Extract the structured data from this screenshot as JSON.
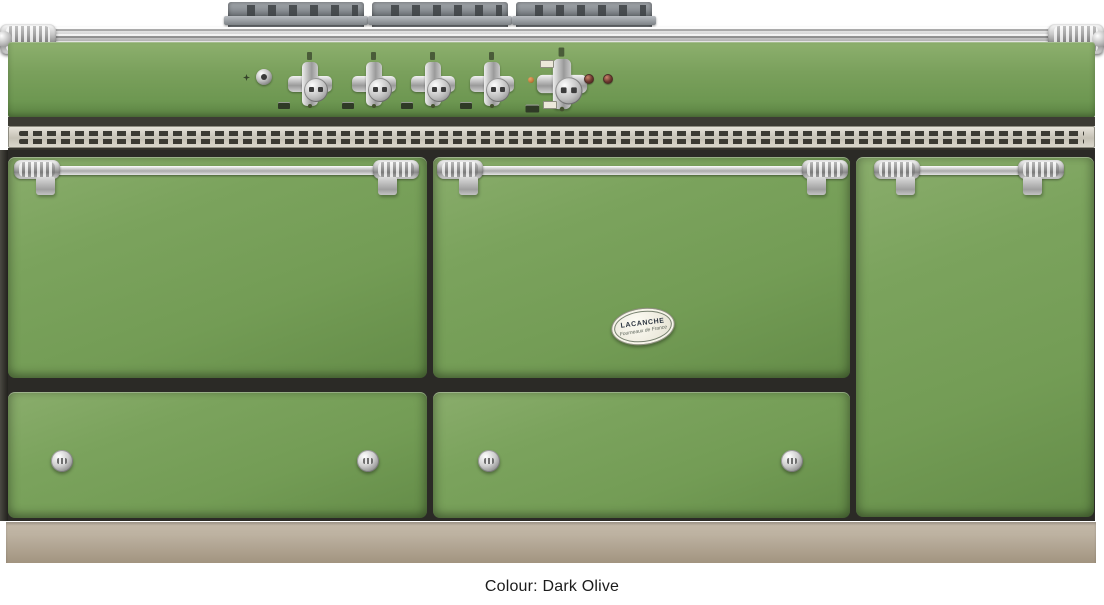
{
  "caption": {
    "text": "Colour: Dark Olive"
  },
  "product": {
    "brand": "Lacanche",
    "colour_name": "Dark Olive",
    "type": "range cooker product photo"
  },
  "badge": {
    "title": "LACANCHE",
    "subtitle": "Fourneaux de France"
  },
  "icons": {
    "burner_knob": "chrome cross-shaped control knob",
    "oven_knob": "large chrome cross-shaped oven knob",
    "ignition_button": "round chrome push button",
    "spark_icon": "small star spark symbol",
    "indicator_light": "round red indicator light",
    "drawer_knob": "round chrome drawer knob",
    "towel_rail": "full-width chrome towel rail",
    "door_handle": "chrome bar handle with end caps",
    "vent_grille": "stainless slotted vent strip",
    "pan_supports": "cast pan supports on hob"
  },
  "theme": {
    "pageBg": "#ffffff",
    "bodyGreen": "#7aa05c",
    "bodyGreenLight": "#8db06e",
    "bodyGreenDark": "#5c8245",
    "ventSteel": "#c9c5bb",
    "ventSlot": "#3b3a33",
    "gapDark": "#2b2a26",
    "plinthLight": "#bdb2a1",
    "plinthDark": "#a29480",
    "indicatorRed": "#6e3a31",
    "indicatorAmber": "#c07a3a",
    "captionColor": "#1c1c1c"
  }
}
